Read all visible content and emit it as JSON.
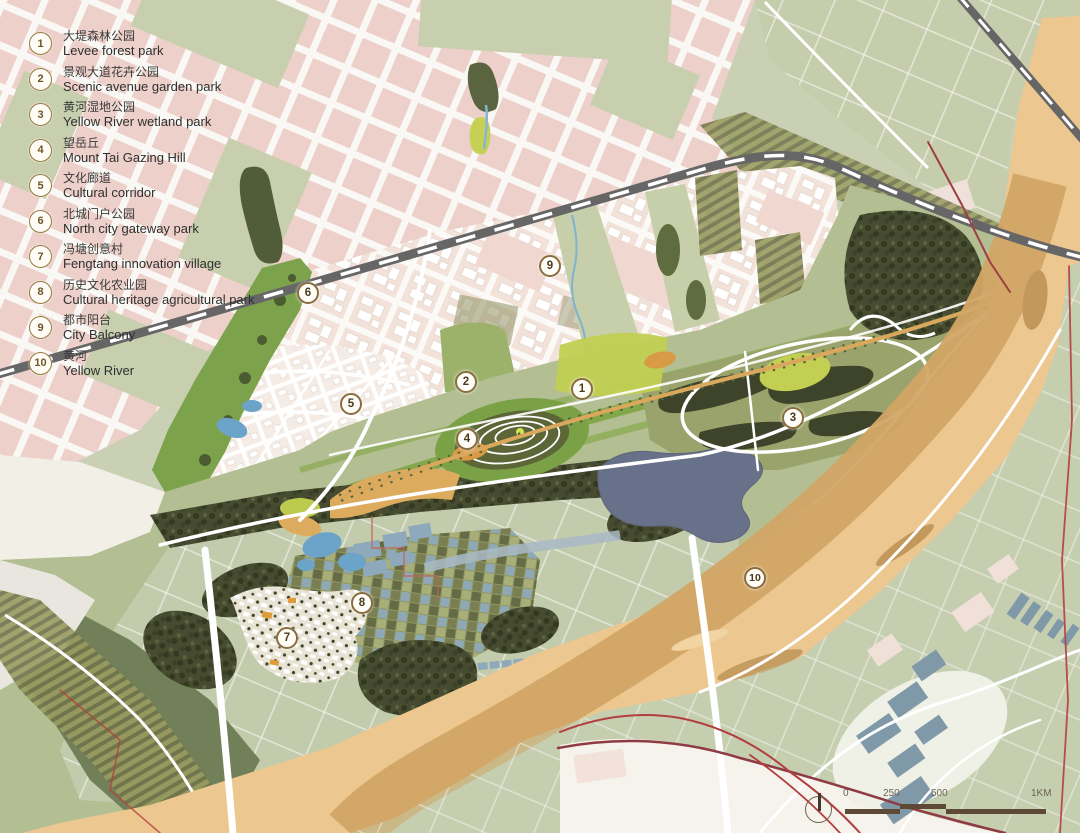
{
  "legend": {
    "items": [
      {
        "num": "1",
        "zh": "大堤森林公园",
        "en": "Levee forest park"
      },
      {
        "num": "2",
        "zh": "景观大道花卉公园",
        "en": "Scenic avenue garden park"
      },
      {
        "num": "3",
        "zh": "黄河湿地公园",
        "en": "Yellow River wetland park"
      },
      {
        "num": "4",
        "zh": "望岳丘",
        "en": "Mount Tai Gazing Hill"
      },
      {
        "num": "5",
        "zh": "文化廊道",
        "en": "Cultural corridor"
      },
      {
        "num": "6",
        "zh": "北城门户公园",
        "en": "North city gateway park"
      },
      {
        "num": "7",
        "zh": "冯塘创意村",
        "en": "Fengtang innovation village"
      },
      {
        "num": "8",
        "zh": "历史文化农业园",
        "en": "Cultural heritage agricultural park"
      },
      {
        "num": "9",
        "zh": "都市阳台",
        "en": "City Balcony"
      },
      {
        "num": "10",
        "zh": "黄河",
        "en": "Yellow River"
      }
    ]
  },
  "map": {
    "markers": [
      {
        "number": "1"
      },
      {
        "number": "2"
      },
      {
        "number": "3"
      },
      {
        "number": "4"
      },
      {
        "number": "5"
      },
      {
        "number": "6"
      },
      {
        "number": "7"
      },
      {
        "number": "8"
      },
      {
        "number": "9"
      },
      {
        "number": "10"
      }
    ]
  },
  "scale_bar": {
    "labels": [
      "0",
      "250",
      "500",
      "1KM"
    ]
  },
  "colors": {
    "river_tan": "#ecc78f",
    "river_channel": "#d2a566",
    "park_green": "#7ba146",
    "forest_dark": "#474c30",
    "urban_pink": "#ecd0c9",
    "water_blue": "#6ba3c9",
    "lake_gray_blue": "#68718a",
    "railway_gray": "#666666",
    "boundary_red": "#b23f3f",
    "marker_ring": "#8a6d3e",
    "road_white": "#ffffff"
  }
}
